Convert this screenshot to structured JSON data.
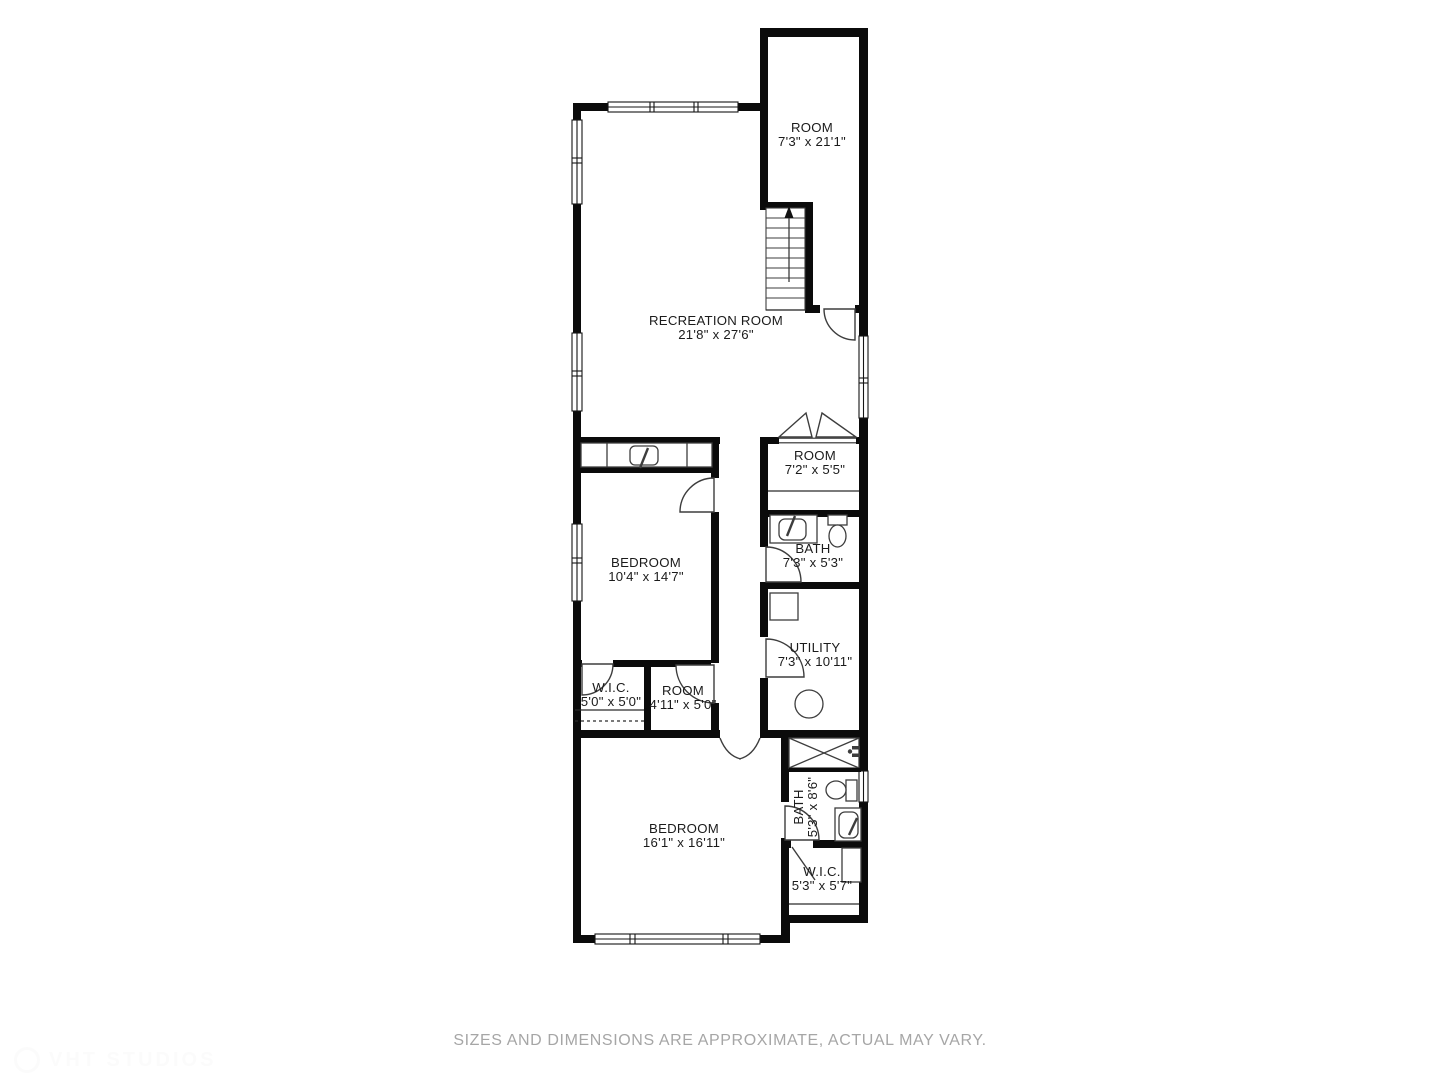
{
  "floor_plan": {
    "rooms": [
      {
        "id": "room-top",
        "name": "ROOM",
        "dims": "7'3\" x 21'1\""
      },
      {
        "id": "recreation-room",
        "name": "RECREATION ROOM",
        "dims": "21'8\" x 27'6\""
      },
      {
        "id": "room-middle",
        "name": "ROOM",
        "dims": "7'2\" x 5'5\""
      },
      {
        "id": "bath-middle",
        "name": "BATH",
        "dims": "7'3\" x 5'3\""
      },
      {
        "id": "bedroom-upper",
        "name": "BEDROOM",
        "dims": "10'4\" x 14'7\""
      },
      {
        "id": "utility",
        "name": "UTILITY",
        "dims": "7'3\" x 10'11\""
      },
      {
        "id": "wic-upper",
        "name": "W.I.C.",
        "dims": "5'0\" x 5'0\""
      },
      {
        "id": "room-small",
        "name": "ROOM",
        "dims": "4'11\" x 5'0\""
      },
      {
        "id": "bedroom-lower",
        "name": "BEDROOM",
        "dims": "16'1\" x 16'11\""
      },
      {
        "id": "bath-lower",
        "name": "BATH",
        "dims": "5'3\" x 8'6\""
      },
      {
        "id": "wic-lower",
        "name": "W.I.C.",
        "dims": "5'3\" x 5'7\""
      }
    ],
    "colors": {
      "wall": "#0b0b0b",
      "fixture_stroke": "#3d3d3d",
      "label": "#1b1b1b",
      "disclaimer": "#a6a6a6"
    }
  },
  "footer": {
    "disclaimer": "SIZES AND DIMENSIONS ARE APPROXIMATE, ACTUAL MAY VARY."
  },
  "watermark": {
    "text": "VHT STUDIOS"
  }
}
